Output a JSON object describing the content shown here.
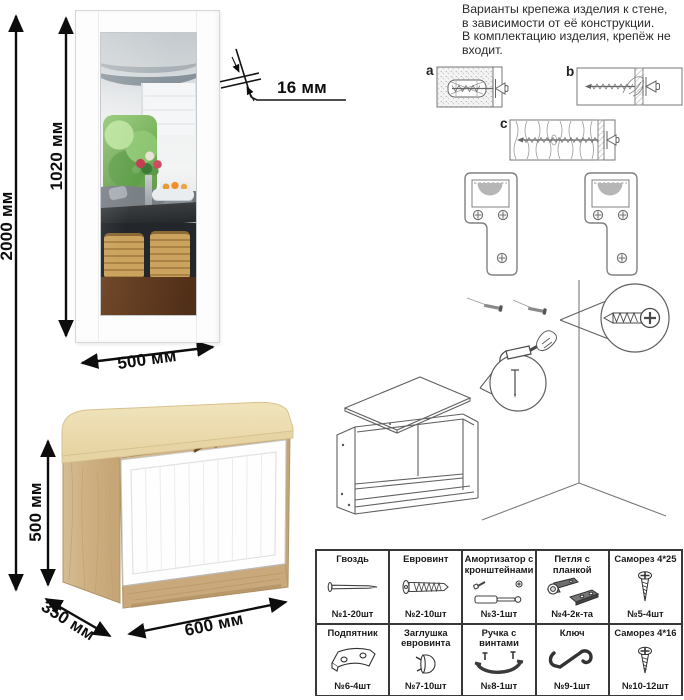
{
  "note": {
    "lines": [
      "Варианты крепежа изделия к стене,",
      "в зависимости от её конструкции.",
      "В комплектацию изделия, крепёж не",
      "входит."
    ]
  },
  "variant_labels": {
    "a": "a",
    "b": "b",
    "c": "c"
  },
  "dims": {
    "total_height": "2000 мм",
    "mirror_height": "1020 мм",
    "mirror_width": "500 мм",
    "panel_thickness": "16 мм",
    "bench_height": "500 мм",
    "bench_depth": "350 мм",
    "bench_width": "600 мм"
  },
  "parts": [
    {
      "name": "Гвоздь",
      "qty": "№1-20шт",
      "icon": "nail-icon"
    },
    {
      "name": "Евровинт",
      "qty": "№2-10шт",
      "icon": "euroscrew-icon"
    },
    {
      "name": "Амортизатор с кронштейнами",
      "qty": "№3-1шт",
      "icon": "gas-lift-icon"
    },
    {
      "name": "Петля с планкой",
      "qty": "№4-2к-та",
      "icon": "hinge-icon"
    },
    {
      "name": "Саморез 4*25",
      "qty": "№5-4шт",
      "icon": "long-screw-icon"
    },
    {
      "name": "Подпятник",
      "qty": "№6-4шт",
      "icon": "footpad-icon"
    },
    {
      "name": "Заглушка евровинта",
      "qty": "№7-10шт",
      "icon": "cap-icon"
    },
    {
      "name": "Ручка с винтами",
      "qty": "№8-1шт",
      "icon": "handle-icon"
    },
    {
      "name": "Ключ",
      "qty": "№9-1шт",
      "icon": "key-icon"
    },
    {
      "name": "Саморез 4*16",
      "qty": "№10-12шт",
      "icon": "short-screw-icon"
    }
  ],
  "colors": {
    "oak": "#ccae80",
    "oak_dark": "#b2956a",
    "cushion": "#ecdcae",
    "door_white": "#fefefe",
    "dimension_line": "#0d0d0d",
    "foliage_green": "#8cc46d",
    "basket_tan": "#cba35f",
    "table_dark": "#2c2f31",
    "floor_brown": "#5a3820",
    "bracket_gray": "#b6b6b6"
  }
}
